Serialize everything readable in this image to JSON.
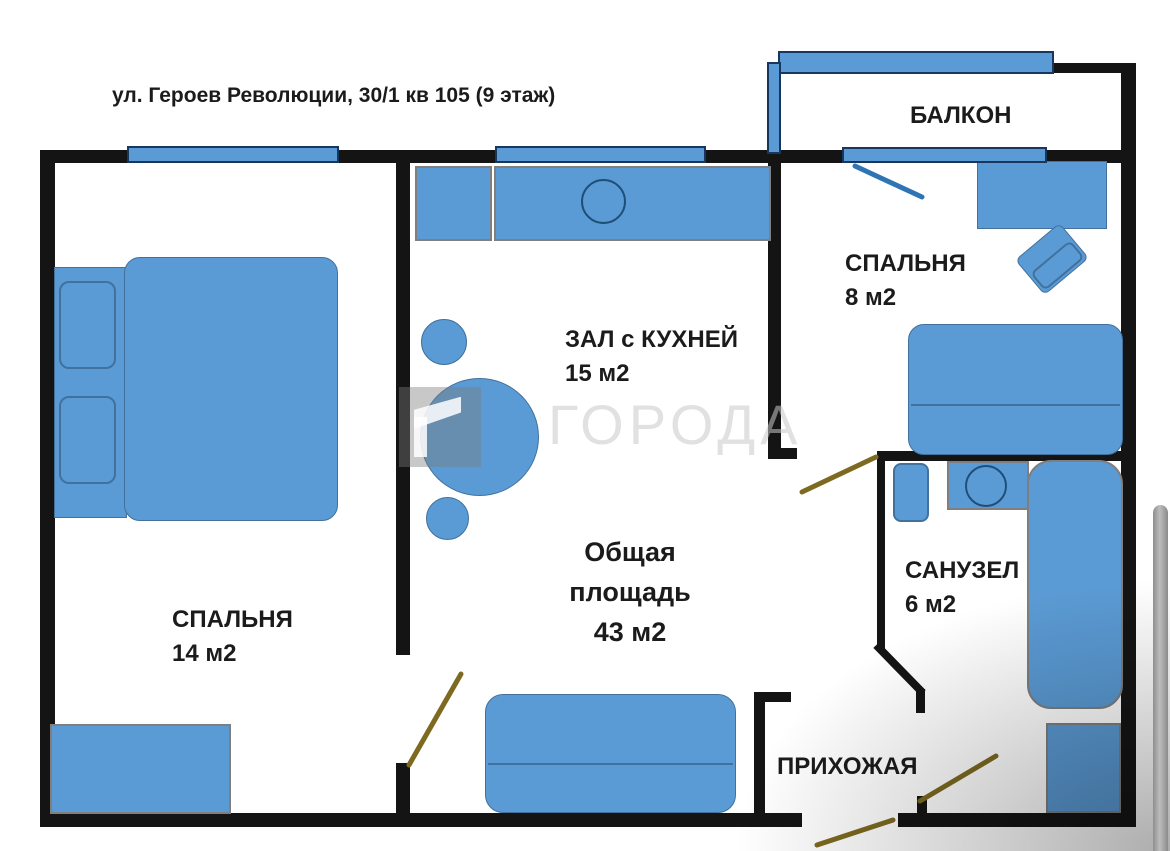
{
  "title": "ул. Героев Революции, 30/1 кв 105 (9 этаж)",
  "watermark": {
    "text": "ГОРОДА"
  },
  "rooms": {
    "balcony": {
      "name": "БАЛКОН"
    },
    "bedroom_small": {
      "name": "СПАЛЬНЯ",
      "area": "8 м2"
    },
    "hall_kitchen": {
      "name": "ЗАЛ с КУХНЕЙ",
      "area": "15 м2"
    },
    "bedroom_large": {
      "name": "СПАЛЬНЯ",
      "area": "14 м2"
    },
    "bathroom": {
      "name": "САНУЗЕЛ",
      "area": "6 м2"
    },
    "hallway": {
      "name": "ПРИХОЖАЯ"
    },
    "total_area": {
      "line1": "Общая",
      "line2": "площадь",
      "line3": "43 м2"
    }
  },
  "colors": {
    "furniture_fill": "#5b9bd5",
    "furniture_border": "#41719c",
    "fixture_outline": "#1f4e79",
    "window_border": "#17375e",
    "wall": "#141414",
    "door_swing": "#7d6a20",
    "balcony_swing": "#2e75b6",
    "label_text": "#1b1b1b",
    "watermark_gray": "#c9c9c9",
    "scrollbar_gray": "#9e9e9e"
  }
}
